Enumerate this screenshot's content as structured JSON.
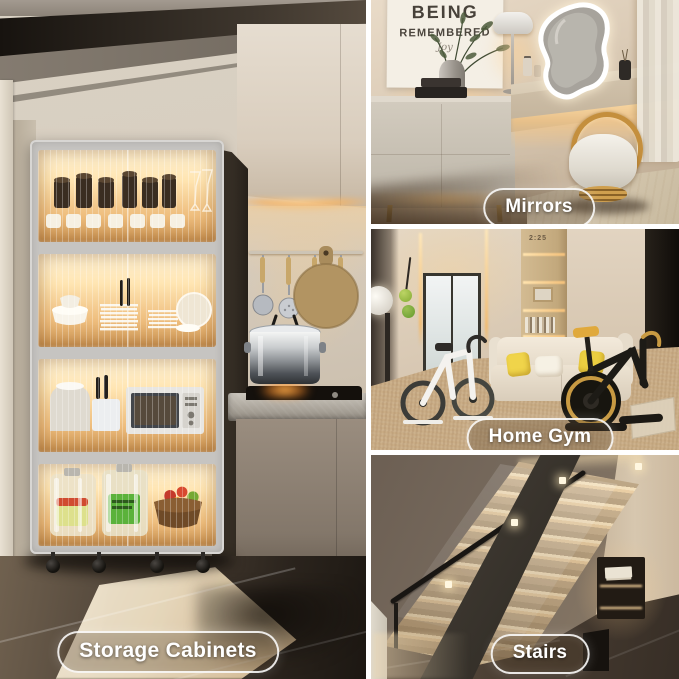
{
  "badges": {
    "storage_cabinets": "Storage Cabinets",
    "mirrors": "Mirrors",
    "home_gym": "Home Gym",
    "stairs": "Stairs"
  },
  "mirrors_scene": {
    "poster_line1": "BEING",
    "poster_line2": "REMEMBERED",
    "poster_script": "Joy"
  },
  "gym_scene": {
    "shelf_decor_numbers": "2:25"
  },
  "colors": {
    "led_glow": "#ffd9a0",
    "badge_border": "#ffffff",
    "badge_background": "rgba(84,64,44,0.32)"
  }
}
